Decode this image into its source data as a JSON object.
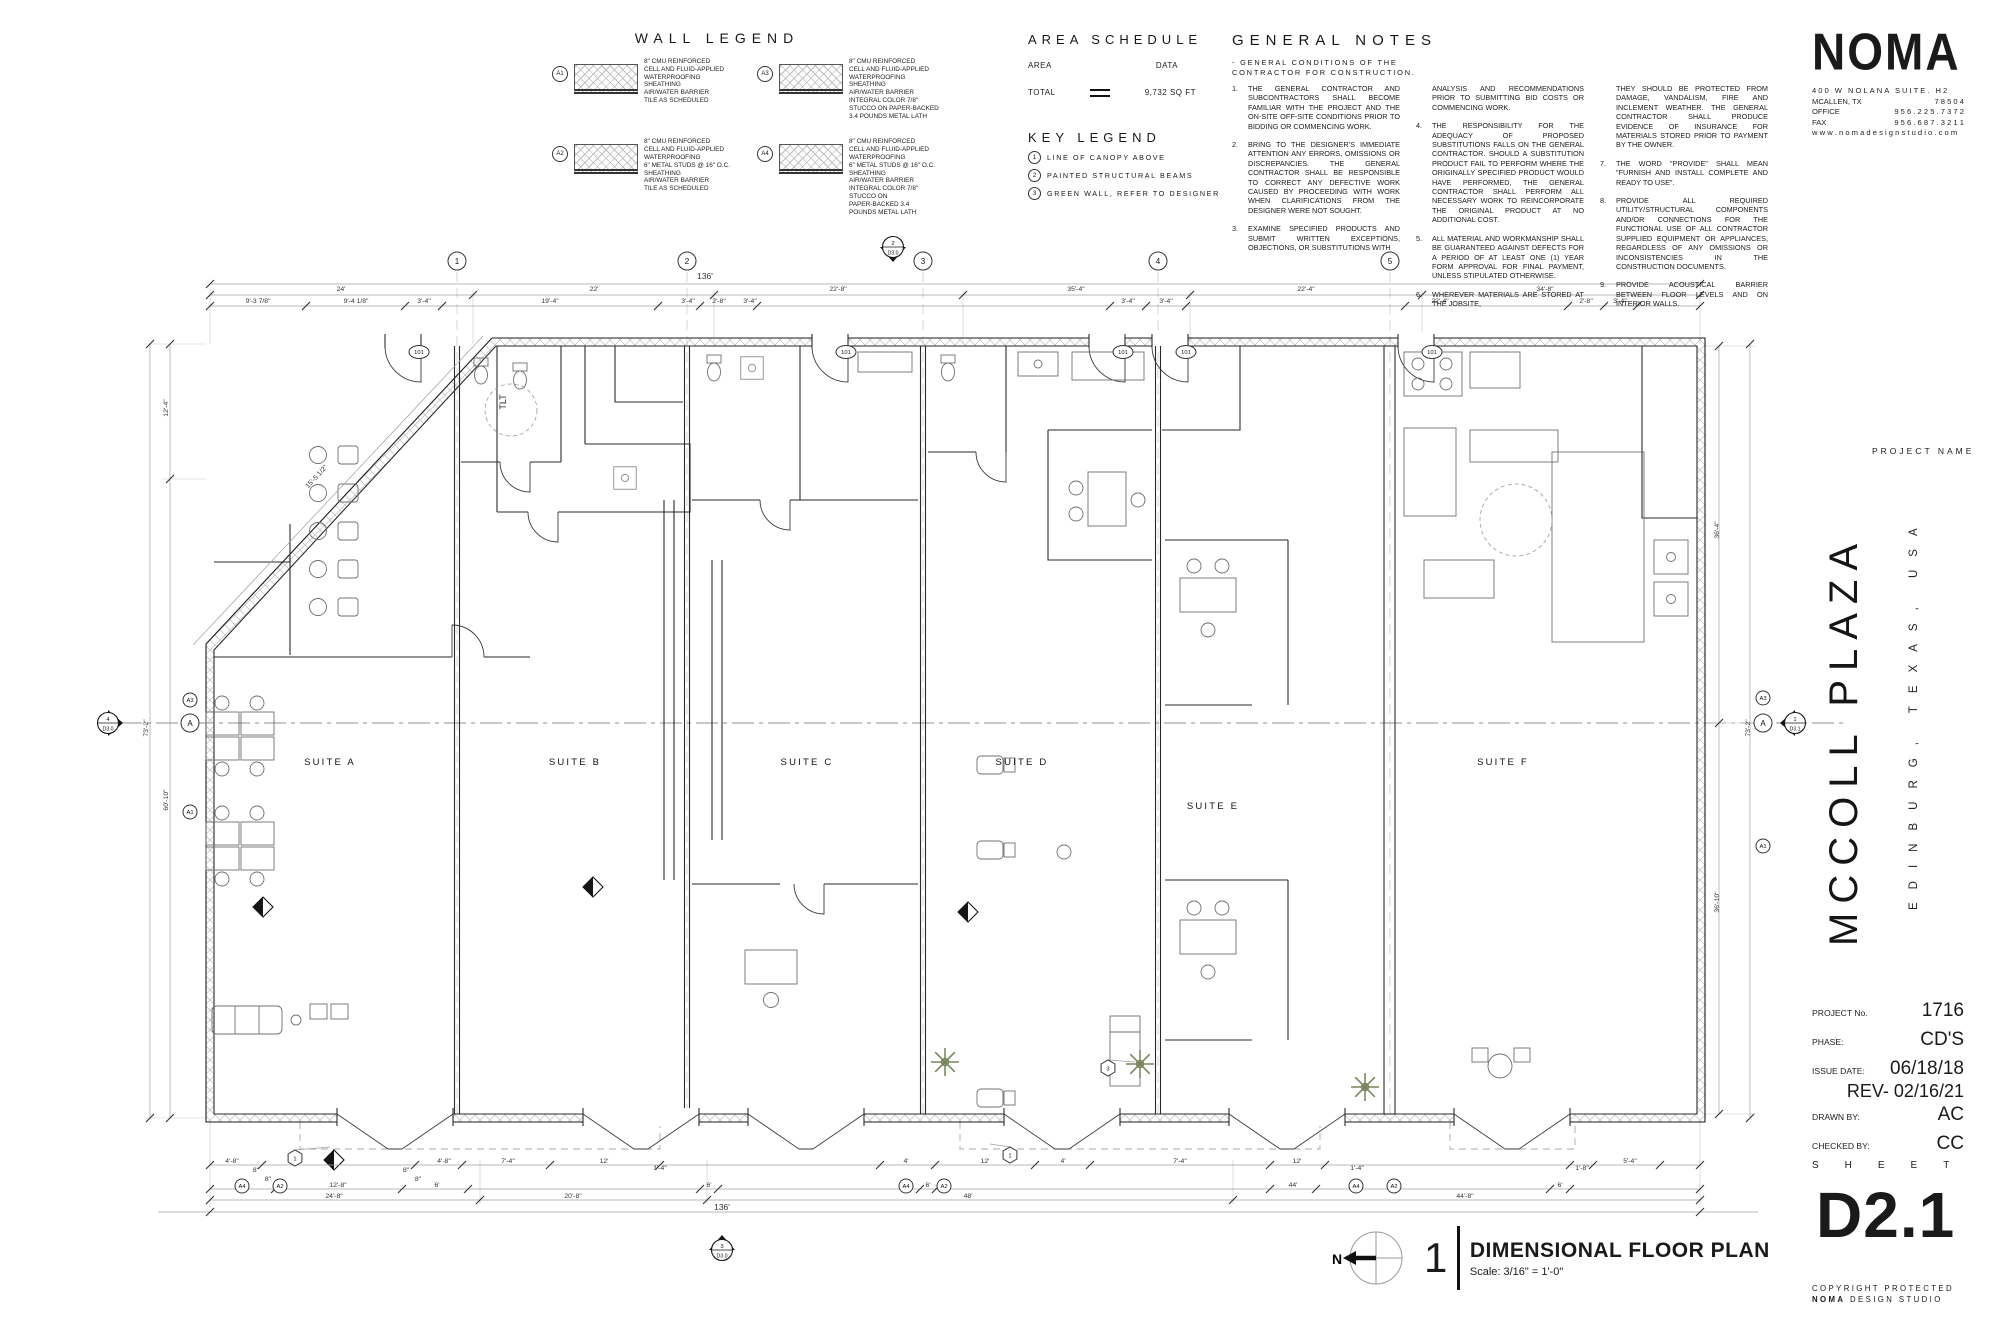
{
  "colors": {
    "ink": "#1a1a1a",
    "line_gray": "#6f6f6f",
    "light_gray": "#a0a0a0",
    "green": "#76865a",
    "paper": "#ffffff"
  },
  "wall_legend": {
    "title": "WALL LEGEND",
    "items": [
      {
        "tag": "A1",
        "lines": "8\" CMU  REINFORCED\nCELL AND FLUID-APPLIED\nWATERPROOFING\nSHEATHING\nAIR/WATER BARRIER\nTILE AS SCHEDULED"
      },
      {
        "tag": "A2",
        "lines": "8\" CMU  REINFORCED\nCELL AND FLUID-APPLIED\nWATERPROOFING\n6\" METAL STUDS @ 16\" O.C.\nSHEATHING\nAIR/WATER BARRIER\nTILE AS SCHEDULED"
      },
      {
        "tag": "A3",
        "lines": "8\" CMU  REINFORCED\nCELL AND FLUID-APPLIED\nWATERPROOFING\nSHEATHING\nAIR/WATER BARRIER\nINTEGRAL COLOR 7/8\"\nSTUCCO ON PAPER-BACKED\n3.4 POUNDS METAL LATH"
      },
      {
        "tag": "A4",
        "lines": "8\" CMU  REINFORCED\nCELL AND FLUID-APPLIED\nWATERPROOFING\n6\" METAL STUDS @ 16\" O.C.\nSHEATHING\nAIR/WATER BARRIER\nINTEGRAL COLOR 7/8\"\nSTUCCO ON\nPAPER-BACKED 3.4\nPOUNDS METAL LATH"
      }
    ]
  },
  "area_schedule": {
    "title": "AREA SCHEDULE",
    "col_area": "AREA",
    "col_data": "DATA",
    "total_label": "TOTAL",
    "total_value": "9,732 SQ FT"
  },
  "key_legend": {
    "title": "KEY LEGEND",
    "items": [
      {
        "n": "1",
        "label": "LINE OF CANOPY ABOVE"
      },
      {
        "n": "2",
        "label": "PAINTED STRUCTURAL BEAMS"
      },
      {
        "n": "3",
        "label": "GREEN WALL, REFER TO DESIGNER"
      }
    ]
  },
  "general_notes": {
    "title": "GENERAL NOTES",
    "intro": "- GENERAL CONDITIONS OF THE\nCONTRACTOR FOR CONSTRUCTION.",
    "col1": [
      {
        "n": "1.",
        "t": "THE GENERAL CONTRACTOR AND SUBCONTRACTORS SHALL BECOME FAMILIAR WITH THE PROJECT AND THE ON-SITE OFF-SITE CONDITIONS PRIOR TO BIDDING OR COMMENCING WORK."
      },
      {
        "n": "2.",
        "t": "BRING TO THE DESIGNER'S IMMEDIATE ATTENTION ANY ERRORS, OMISSIONS OR DISCREPANCIES. THE GENERAL CONTRACTOR SHALL BE RESPONSIBLE TO CORRECT ANY DEFECTIVE WORK CAUSED BY PROCEEDING WITH WORK WHEN CLARIFICATIONS FROM THE  DESIGNER WERE NOT SOUGHT."
      },
      {
        "n": "3.",
        "t": "EXAMINE SPECIFIED PRODUCTS AND SUBMIT WRITTEN EXCEPTIONS, OBJECTIONS, OR SUBSTITUTIONS WITH"
      }
    ],
    "col2": [
      {
        "n": "",
        "t": "ANALYSIS AND RECOMMENDATIONS PRIOR TO SUBMITTING BID COSTS OR COMMENCING WORK."
      },
      {
        "n": "4.",
        "t": "THE RESPONSIBILITY FOR THE ADEQUACY OF PROPOSED SUBSTITUTIONS FALLS ON THE GENERAL CONTRACTOR. SHOULD A SUBSTITUTION PRODUCT FAIL TO PERFORM WHERE THE ORIGINALLY SPECIFIED PRODUCT WOULD HAVE PERFORMED, THE GENERAL CONTRACTOR SHALL PERFORM ALL NECESSARY WORK TO REINCORPORATE THE ORIGINAL PRODUCT AT NO ADDITIONAL COST."
      },
      {
        "n": "5.",
        "t": "ALL MATERIAL AND WORKMANSHIP SHALL BE GUARANTEED AGAINST DEFECTS FOR A PERIOD OF AT LEAST ONE (1) YEAR FORM APPROVAL FOR FINAL PAYMENT, UNLESS STIPULATED OTHERWISE."
      },
      {
        "n": "6.",
        "t": "WHEREVER MATERIALS ARE STORED AT THE JOBSITE,"
      }
    ],
    "col3": [
      {
        "n": "",
        "t": "THEY SHOULD BE PROTECTED FROM DAMAGE, VANDALISM, FIRE AND INCLEMENT WEATHER. THE GENERAL CONTRACTOR SHALL PRODUCE EVIDENCE OF INSURANCE FOR MATERIALS STORED PRIOR TO PAYMENT BY THE OWNER."
      },
      {
        "n": "7.",
        "t": "THE WORD \"PROVIDE\" SHALL MEAN \"FURNISH AND INSTALL COMPLETE AND READY TO USE\"."
      },
      {
        "n": "8.",
        "t": "PROVIDE ALL REQUIRED UTILITY/STRUCTURAL COMPONENTS AND/OR CONNECTIONS FOR THE FUNCTIONAL USE OF ALL CONTRACTOR SUPPLIED EQUIPMENT OR APPLIANCES, REGARDLESS OF ANY OMISSIONS OR INCONSISTENCIES IN THE CONSTRUCTION DOCUMENTS."
      },
      {
        "n": "9.",
        "t": "PROVIDE ACOUSTICAL BARRIER BETWEEN FLOOR LEVELS AND ON INTERIOR WALLS."
      }
    ]
  },
  "noma": {
    "logo": "NOMA",
    "address1": "400 W NOLANA SUITE. H2",
    "city": "MCALLEN,  TX",
    "zip": "7 8 5 0 4",
    "office_label": "OFFICE",
    "office": "9 5 6 . 2 2 5 . 7 3 7 2",
    "fax_label": "FAX",
    "fax": "9 5 6 . 6 8 7 . 3 2 1 1",
    "web": "w w w .   n o m a d e s i g n s t u d i o . c o m"
  },
  "title_block": {
    "project_name_label": "PROJECT NAME",
    "project_name": "MCCOLL PLAZA",
    "project_location": "EDINBURG, TEXAS, USA",
    "rows": [
      {
        "label": "PROJECT No.",
        "value": "1716"
      },
      {
        "label": "PHASE:",
        "value": "CD'S"
      },
      {
        "label": "ISSUE DATE:",
        "value": "06/18/18"
      }
    ],
    "rev": "REV- 02/16/21",
    "rows2": [
      {
        "label": "DRAWN BY:",
        "value": "AC"
      },
      {
        "label": "CHECKED BY:",
        "value": "CC"
      }
    ],
    "sheet_label": "SHEET",
    "sheet_number": "D2.1",
    "copyright_line1": "COPYRIGHT PROTECTED",
    "copyright_bold": "NOMA",
    "copyright_rest": " DESIGN STUDIO"
  },
  "drawing_title": {
    "number": "1",
    "title": "DIMENSIONAL FLOOR PLAN",
    "scale": "Scale: 3/16\" = 1'-0\"",
    "north": "N"
  },
  "plan": {
    "suite_labels": [
      {
        "t": "SUITE A",
        "x": 330,
        "y": 765
      },
      {
        "t": "SUITE B",
        "x": 575,
        "y": 765
      },
      {
        "t": "SUITE C",
        "x": 807,
        "y": 765
      },
      {
        "t": "SUITE D",
        "x": 1022,
        "y": 765
      },
      {
        "t": "SUITE E",
        "x": 1213,
        "y": 809
      },
      {
        "t": "SUITE F",
        "x": 1503,
        "y": 765
      }
    ],
    "room_labels": [
      {
        "t": "TLT",
        "x": 506,
        "y": 402,
        "r": -90
      }
    ],
    "grid_bubbles": [
      {
        "t": "1",
        "x": 457,
        "y": 261
      },
      {
        "t": "2",
        "x": 687,
        "y": 261
      },
      {
        "t": "3",
        "x": 923,
        "y": 261
      },
      {
        "t": "4",
        "x": 1158,
        "y": 261
      },
      {
        "t": "5",
        "x": 1390,
        "y": 261
      },
      {
        "t": "A",
        "x": 190,
        "y": 723
      },
      {
        "t": "A",
        "x": 1763,
        "y": 723
      }
    ],
    "wall_tags": [
      {
        "t": "A3",
        "x": 190,
        "y": 700
      },
      {
        "t": "A1",
        "x": 190,
        "y": 812
      },
      {
        "t": "A3",
        "x": 1763,
        "y": 698
      },
      {
        "t": "A1",
        "x": 1763,
        "y": 846
      },
      {
        "t": "A4",
        "x": 242,
        "y": 1186
      },
      {
        "t": "A2",
        "x": 280,
        "y": 1186
      },
      {
        "t": "A4",
        "x": 906,
        "y": 1186
      },
      {
        "t": "A2",
        "x": 944,
        "y": 1186
      },
      {
        "t": "A4",
        "x": 1356,
        "y": 1186
      },
      {
        "t": "A2",
        "x": 1394,
        "y": 1186
      }
    ],
    "door_tags": [
      {
        "t": "101",
        "x": 419,
        "y": 352
      },
      {
        "t": "101",
        "x": 846,
        "y": 352
      },
      {
        "t": "101",
        "x": 1123,
        "y": 352
      },
      {
        "t": "101",
        "x": 1186,
        "y": 352
      },
      {
        "t": "101",
        "x": 1432,
        "y": 352
      }
    ],
    "keynotes": [
      {
        "t": "1",
        "x": 295,
        "y": 1158
      },
      {
        "t": "1",
        "x": 1010,
        "y": 1155
      },
      {
        "t": "3",
        "x": 1108,
        "y": 1068
      }
    ],
    "section_markers": [
      {
        "num": "2",
        "sheet": "D3.0",
        "x": 893,
        "y": 247,
        "dir": "down"
      },
      {
        "num": "4",
        "sheet": "D3.0",
        "x": 108,
        "y": 723,
        "dir": "right"
      },
      {
        "num": "3",
        "sheet": "D3.0",
        "x": 722,
        "y": 1250,
        "dir": "up"
      },
      {
        "num": "1",
        "sheet": "D3.1",
        "x": 1795,
        "y": 723,
        "dir": "left"
      }
    ],
    "dims": [
      {
        "t": "136'",
        "x": 705,
        "y": 279,
        "big": 1
      },
      {
        "t": "24'",
        "x": 341,
        "y": 291
      },
      {
        "t": "22'",
        "x": 594,
        "y": 291
      },
      {
        "t": "22'-8\"",
        "x": 838,
        "y": 291
      },
      {
        "t": "35'-4\"",
        "x": 1076,
        "y": 291
      },
      {
        "t": "22'-4\"",
        "x": 1306,
        "y": 291
      },
      {
        "t": "34'-8\"",
        "x": 1545,
        "y": 291
      },
      {
        "t": "9'-3 7/8\"",
        "x": 258,
        "y": 303
      },
      {
        "t": "9'-4 1/8\"",
        "x": 356,
        "y": 303
      },
      {
        "t": "3'-4\"",
        "x": 424,
        "y": 303
      },
      {
        "t": "19'-4\"",
        "x": 550,
        "y": 303
      },
      {
        "t": "3'-4\"",
        "x": 688,
        "y": 303
      },
      {
        "t": "2'-8\"",
        "x": 719,
        "y": 303
      },
      {
        "t": "3'-4\"",
        "x": 750,
        "y": 303
      },
      {
        "t": "3'-4\"",
        "x": 1128,
        "y": 303
      },
      {
        "t": "3'-4\"",
        "x": 1166,
        "y": 303
      },
      {
        "t": "22'-4\"",
        "x": 1440,
        "y": 303
      },
      {
        "t": "2'-8\"",
        "x": 1586,
        "y": 303
      },
      {
        "t": "3'-4\"",
        "x": 1620,
        "y": 303
      },
      {
        "t": "4'-8\"",
        "x": 232,
        "y": 1163
      },
      {
        "t": "8\"",
        "x": 256,
        "y": 1172
      },
      {
        "t": "8\"",
        "x": 268,
        "y": 1181
      },
      {
        "t": "8\"",
        "x": 406,
        "y": 1172
      },
      {
        "t": "8\"",
        "x": 418,
        "y": 1181
      },
      {
        "t": "4'-8\"",
        "x": 444,
        "y": 1163
      },
      {
        "t": "7'-4\"",
        "x": 508,
        "y": 1163
      },
      {
        "t": "12'",
        "x": 604,
        "y": 1163
      },
      {
        "t": "1'-4\"",
        "x": 660,
        "y": 1170
      },
      {
        "t": "4'",
        "x": 906,
        "y": 1163
      },
      {
        "t": "12'",
        "x": 985,
        "y": 1163
      },
      {
        "t": "4'",
        "x": 1063,
        "y": 1163
      },
      {
        "t": "7'-4\"",
        "x": 1180,
        "y": 1163
      },
      {
        "t": "12'",
        "x": 1297,
        "y": 1163
      },
      {
        "t": "1'-4\"",
        "x": 1357,
        "y": 1170
      },
      {
        "t": "1'-8\"",
        "x": 1582,
        "y": 1170
      },
      {
        "t": "5'-4\"",
        "x": 1630,
        "y": 1163
      },
      {
        "t": "6'",
        "x": 241,
        "y": 1187
      },
      {
        "t": "12'-8\"",
        "x": 338,
        "y": 1187
      },
      {
        "t": "6'",
        "x": 437,
        "y": 1187
      },
      {
        "t": "6'",
        "x": 709,
        "y": 1187
      },
      {
        "t": "6'",
        "x": 928,
        "y": 1187
      },
      {
        "t": "44'",
        "x": 1293,
        "y": 1187
      },
      {
        "t": "6'",
        "x": 1560,
        "y": 1187
      },
      {
        "t": "24'-8\"",
        "x": 334,
        "y": 1198
      },
      {
        "t": "20'-8\"",
        "x": 573,
        "y": 1198
      },
      {
        "t": "48'",
        "x": 968,
        "y": 1198
      },
      {
        "t": "44'-8\"",
        "x": 1465,
        "y": 1198
      },
      {
        "t": "136'",
        "x": 722,
        "y": 1210,
        "big": 1
      },
      {
        "t": "12'-4\"",
        "x": 168,
        "y": 408,
        "r": -90
      },
      {
        "t": "73'-2\"",
        "x": 148,
        "y": 728,
        "r": -90
      },
      {
        "t": "60'-10\"",
        "x": 168,
        "y": 800,
        "r": -90
      },
      {
        "t": "15'-5 1/2\"",
        "x": 318,
        "y": 478,
        "r": -47
      },
      {
        "t": "36'-4\"",
        "x": 1719,
        "y": 530,
        "r": -90
      },
      {
        "t": "36'-10\"",
        "x": 1719,
        "y": 902,
        "r": -90
      },
      {
        "t": "73'-2\"",
        "x": 1750,
        "y": 728,
        "r": -90
      }
    ],
    "dim_lines": [
      {
        "x1": 210,
        "y1": 284,
        "x2": 1700,
        "y2": 284,
        "ticks": [
          210,
          1700
        ]
      },
      {
        "x1": 210,
        "y1": 295,
        "x2": 1700,
        "y2": 295,
        "ticks": [
          210,
          473,
          714,
          963,
          1190,
          1422,
          1700
        ]
      },
      {
        "x1": 210,
        "y1": 306,
        "x2": 1700,
        "y2": 306,
        "ticks": [
          210,
          306,
          405,
          442,
          658,
          700,
          757,
          1110,
          1146,
          1186,
          1405,
          1568,
          1604,
          1637,
          1700
        ]
      },
      {
        "x1": 210,
        "y1": 1165,
        "x2": 1700,
        "y2": 1165,
        "ticks": [
          210,
          262,
          415,
          462,
          550,
          660,
          880,
          935,
          1035,
          1090,
          1270,
          1325,
          1570,
          1593,
          1660,
          1700
        ]
      },
      {
        "x1": 210,
        "y1": 1189,
        "x2": 1700,
        "y2": 1189,
        "ticks": [
          210,
          275,
          402,
          468,
          700,
          718,
          920,
          936,
          1270,
          1316,
          1550,
          1570,
          1700
        ]
      },
      {
        "x1": 210,
        "y1": 1200,
        "x2": 1700,
        "y2": 1200,
        "ticks": [
          210,
          480,
          707,
          1233,
          1700
        ]
      },
      {
        "x1": 158,
        "y1": 1212,
        "x2": 1758,
        "y2": 1212,
        "ticks": [
          210,
          1700
        ]
      },
      {
        "x1": 150,
        "y1": 344,
        "x2": 150,
        "y2": 1118,
        "ticks": [
          344,
          1118
        ]
      },
      {
        "x1": 170,
        "y1": 344,
        "x2": 170,
        "y2": 1118,
        "ticks": [
          344,
          479,
          1118
        ]
      },
      {
        "x1": 1719,
        "y1": 346,
        "x2": 1719,
        "y2": 1114,
        "ticks": [
          346,
          723,
          1114
        ]
      },
      {
        "x1": 1750,
        "y1": 344,
        "x2": 1750,
        "y2": 1118,
        "ticks": [
          344,
          1118
        ]
      },
      {
        "x1": 193,
        "y1": 645,
        "x2": 483,
        "y2": 336,
        "ticks": []
      }
    ]
  }
}
